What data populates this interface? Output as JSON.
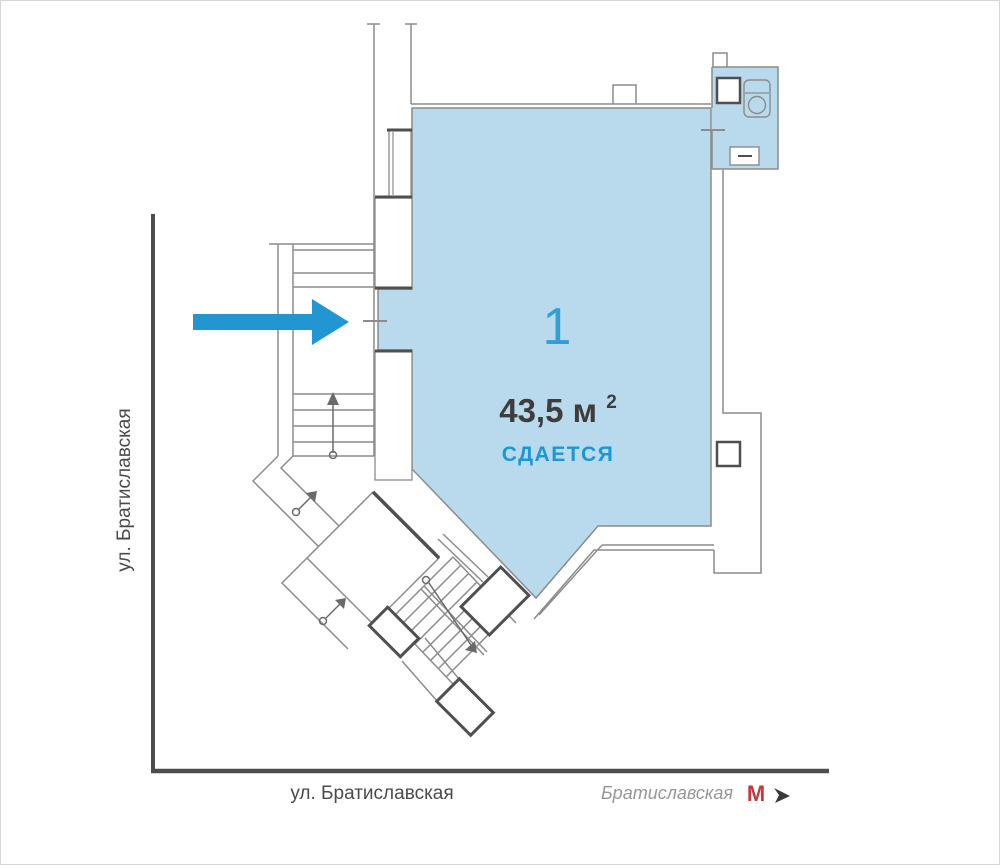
{
  "plan": {
    "unit_number": "1",
    "area_label": "43,5 м",
    "area_superscript": "2",
    "status_label": "СДАЕТСЯ"
  },
  "streets": {
    "left_label": "ул. Братиславская",
    "bottom_label": "ул. Братиславская"
  },
  "metro": {
    "station_label": "Братиславская",
    "logo_letter": "М"
  },
  "colors": {
    "accent_blue": "#2196d3",
    "room_fill": "#b9d9ec",
    "unit_number_blue": "#2f9fd7",
    "status_blue": "#1d97d4",
    "text_dark": "#3d3d3d",
    "street_line": "#4d4d4d",
    "street_text": "#4a4a4a",
    "wall_gray": "#8c8c8c",
    "wall_dark": "#4f4f4f",
    "metro_red": "#c6383e",
    "metro_text_gray": "#979797"
  }
}
